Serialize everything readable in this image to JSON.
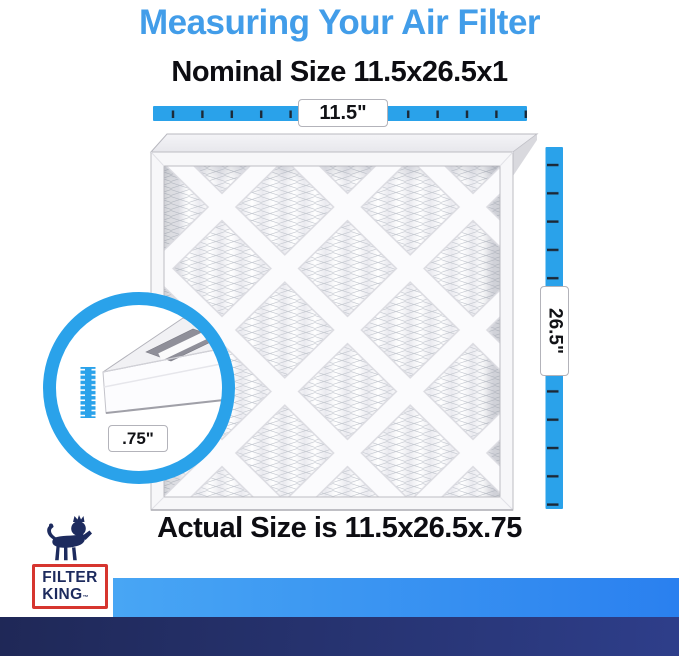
{
  "header": {
    "title": "Measuring Your Air Filter",
    "subtitle": "Nominal Size 11.5x26.5x1"
  },
  "measurements": {
    "width_label": "11.5\"",
    "height_label": "26.5\"",
    "depth_label": ".75\""
  },
  "footer": {
    "caption": "Actual Size is 11.5x26.5x.75"
  },
  "logo": {
    "line1": "FILTER",
    "line2": "KING",
    "trademark": "™"
  },
  "icons": {
    "lion": "filter-king-lion-crown",
    "width_ruler": "horizontal-blue-ruler",
    "height_ruler": "vertical-blue-ruler",
    "depth_ruler": "mini-blue-ruler",
    "zoom_circle": "blue-magnifier-ring"
  },
  "colors": {
    "title_blue": "#429de9",
    "ruler_blue": "#2aa2ea",
    "tick_dark": "#1c2836",
    "logo_navy": "#1d2b5e",
    "logo_red": "#d6352f",
    "bar_light_gradient": [
      "#48a6f4",
      "#2a80ef"
    ],
    "bar_dark_gradient": [
      "#1f2857",
      "#2e3e8a"
    ],
    "text_black": "#0d0d12"
  }
}
